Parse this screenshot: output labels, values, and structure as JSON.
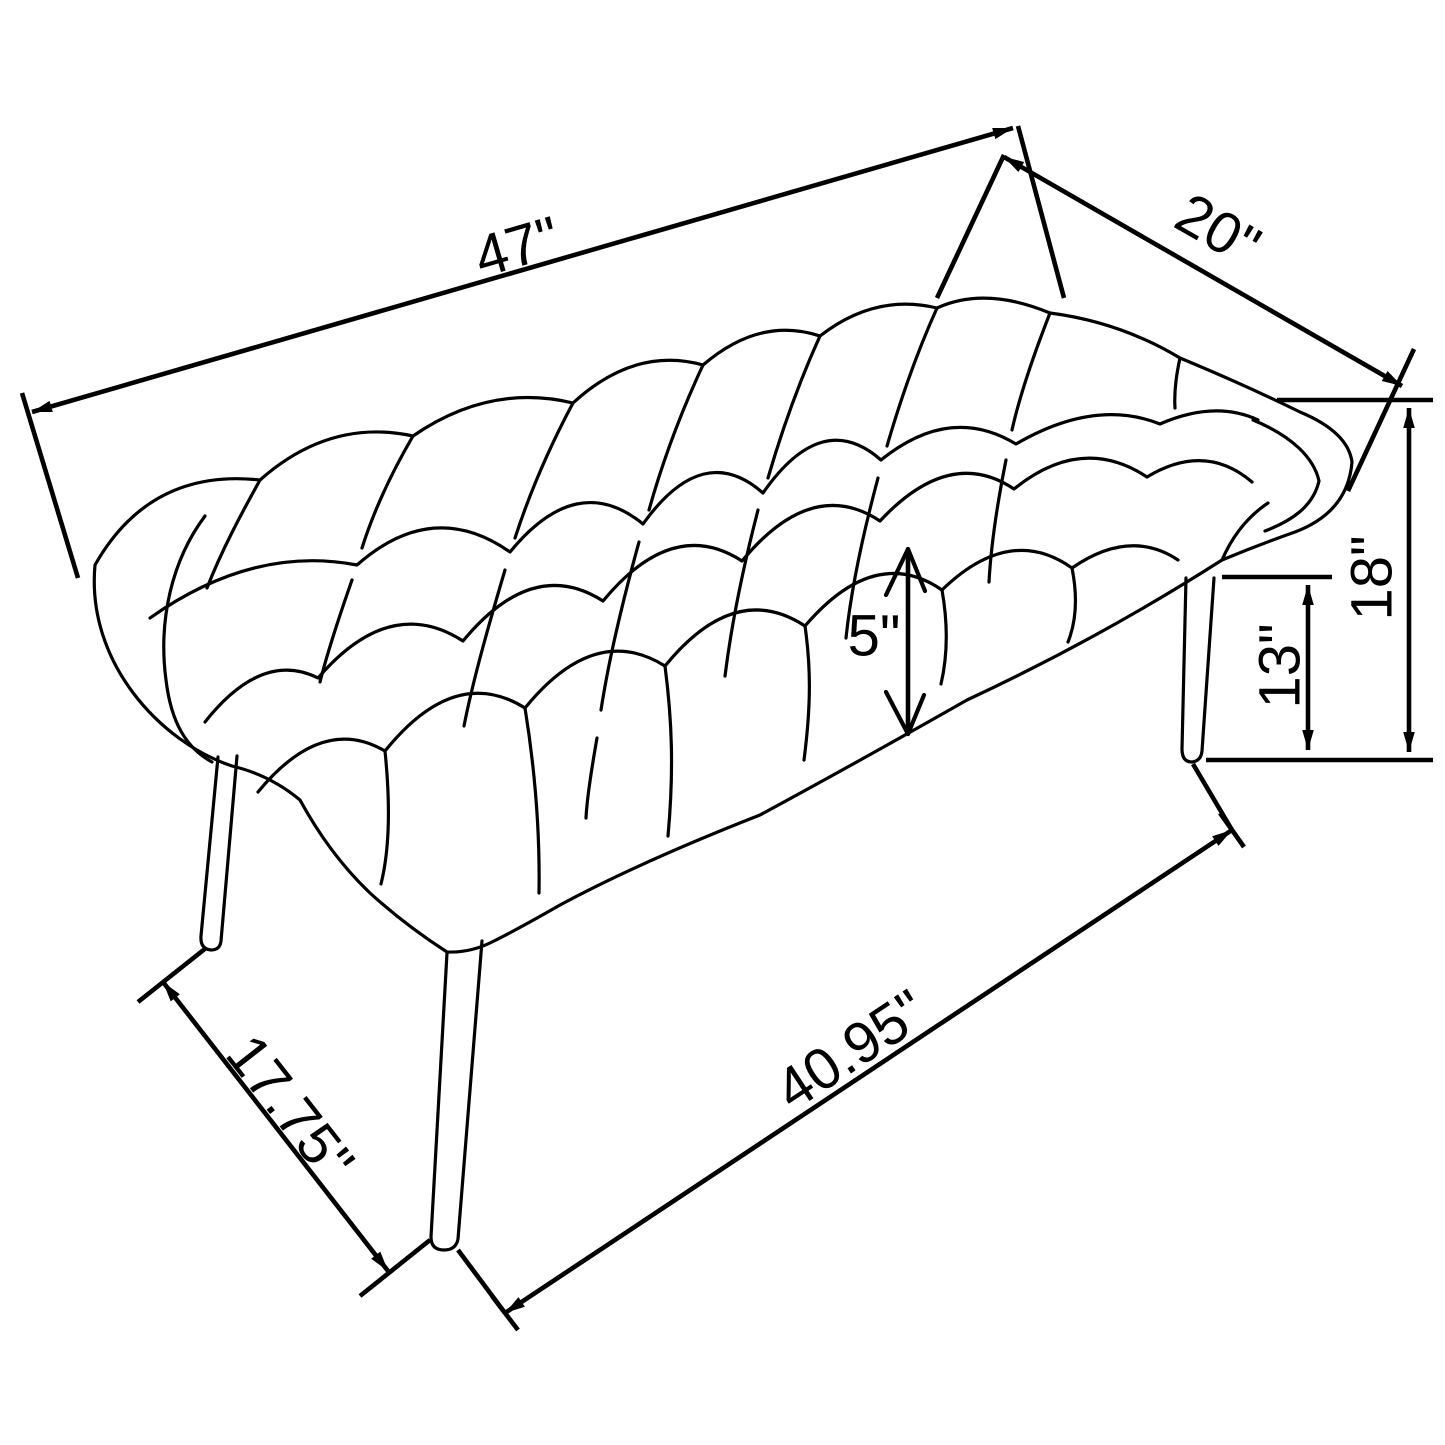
{
  "diagram": {
    "type": "furniture-dimension-drawing",
    "subject": "button-tufted bench with splayed tapered legs, isometric line drawing",
    "background_color": "#ffffff",
    "line_color": "#000000",
    "labels": {
      "length": "47\"",
      "depth": "20\"",
      "overall_height": "18\"",
      "leg_height": "13\"",
      "cushion_thickness": "5\"",
      "leg_spread_side": "17.75\"",
      "leg_spread_front": "40.95\""
    }
  }
}
